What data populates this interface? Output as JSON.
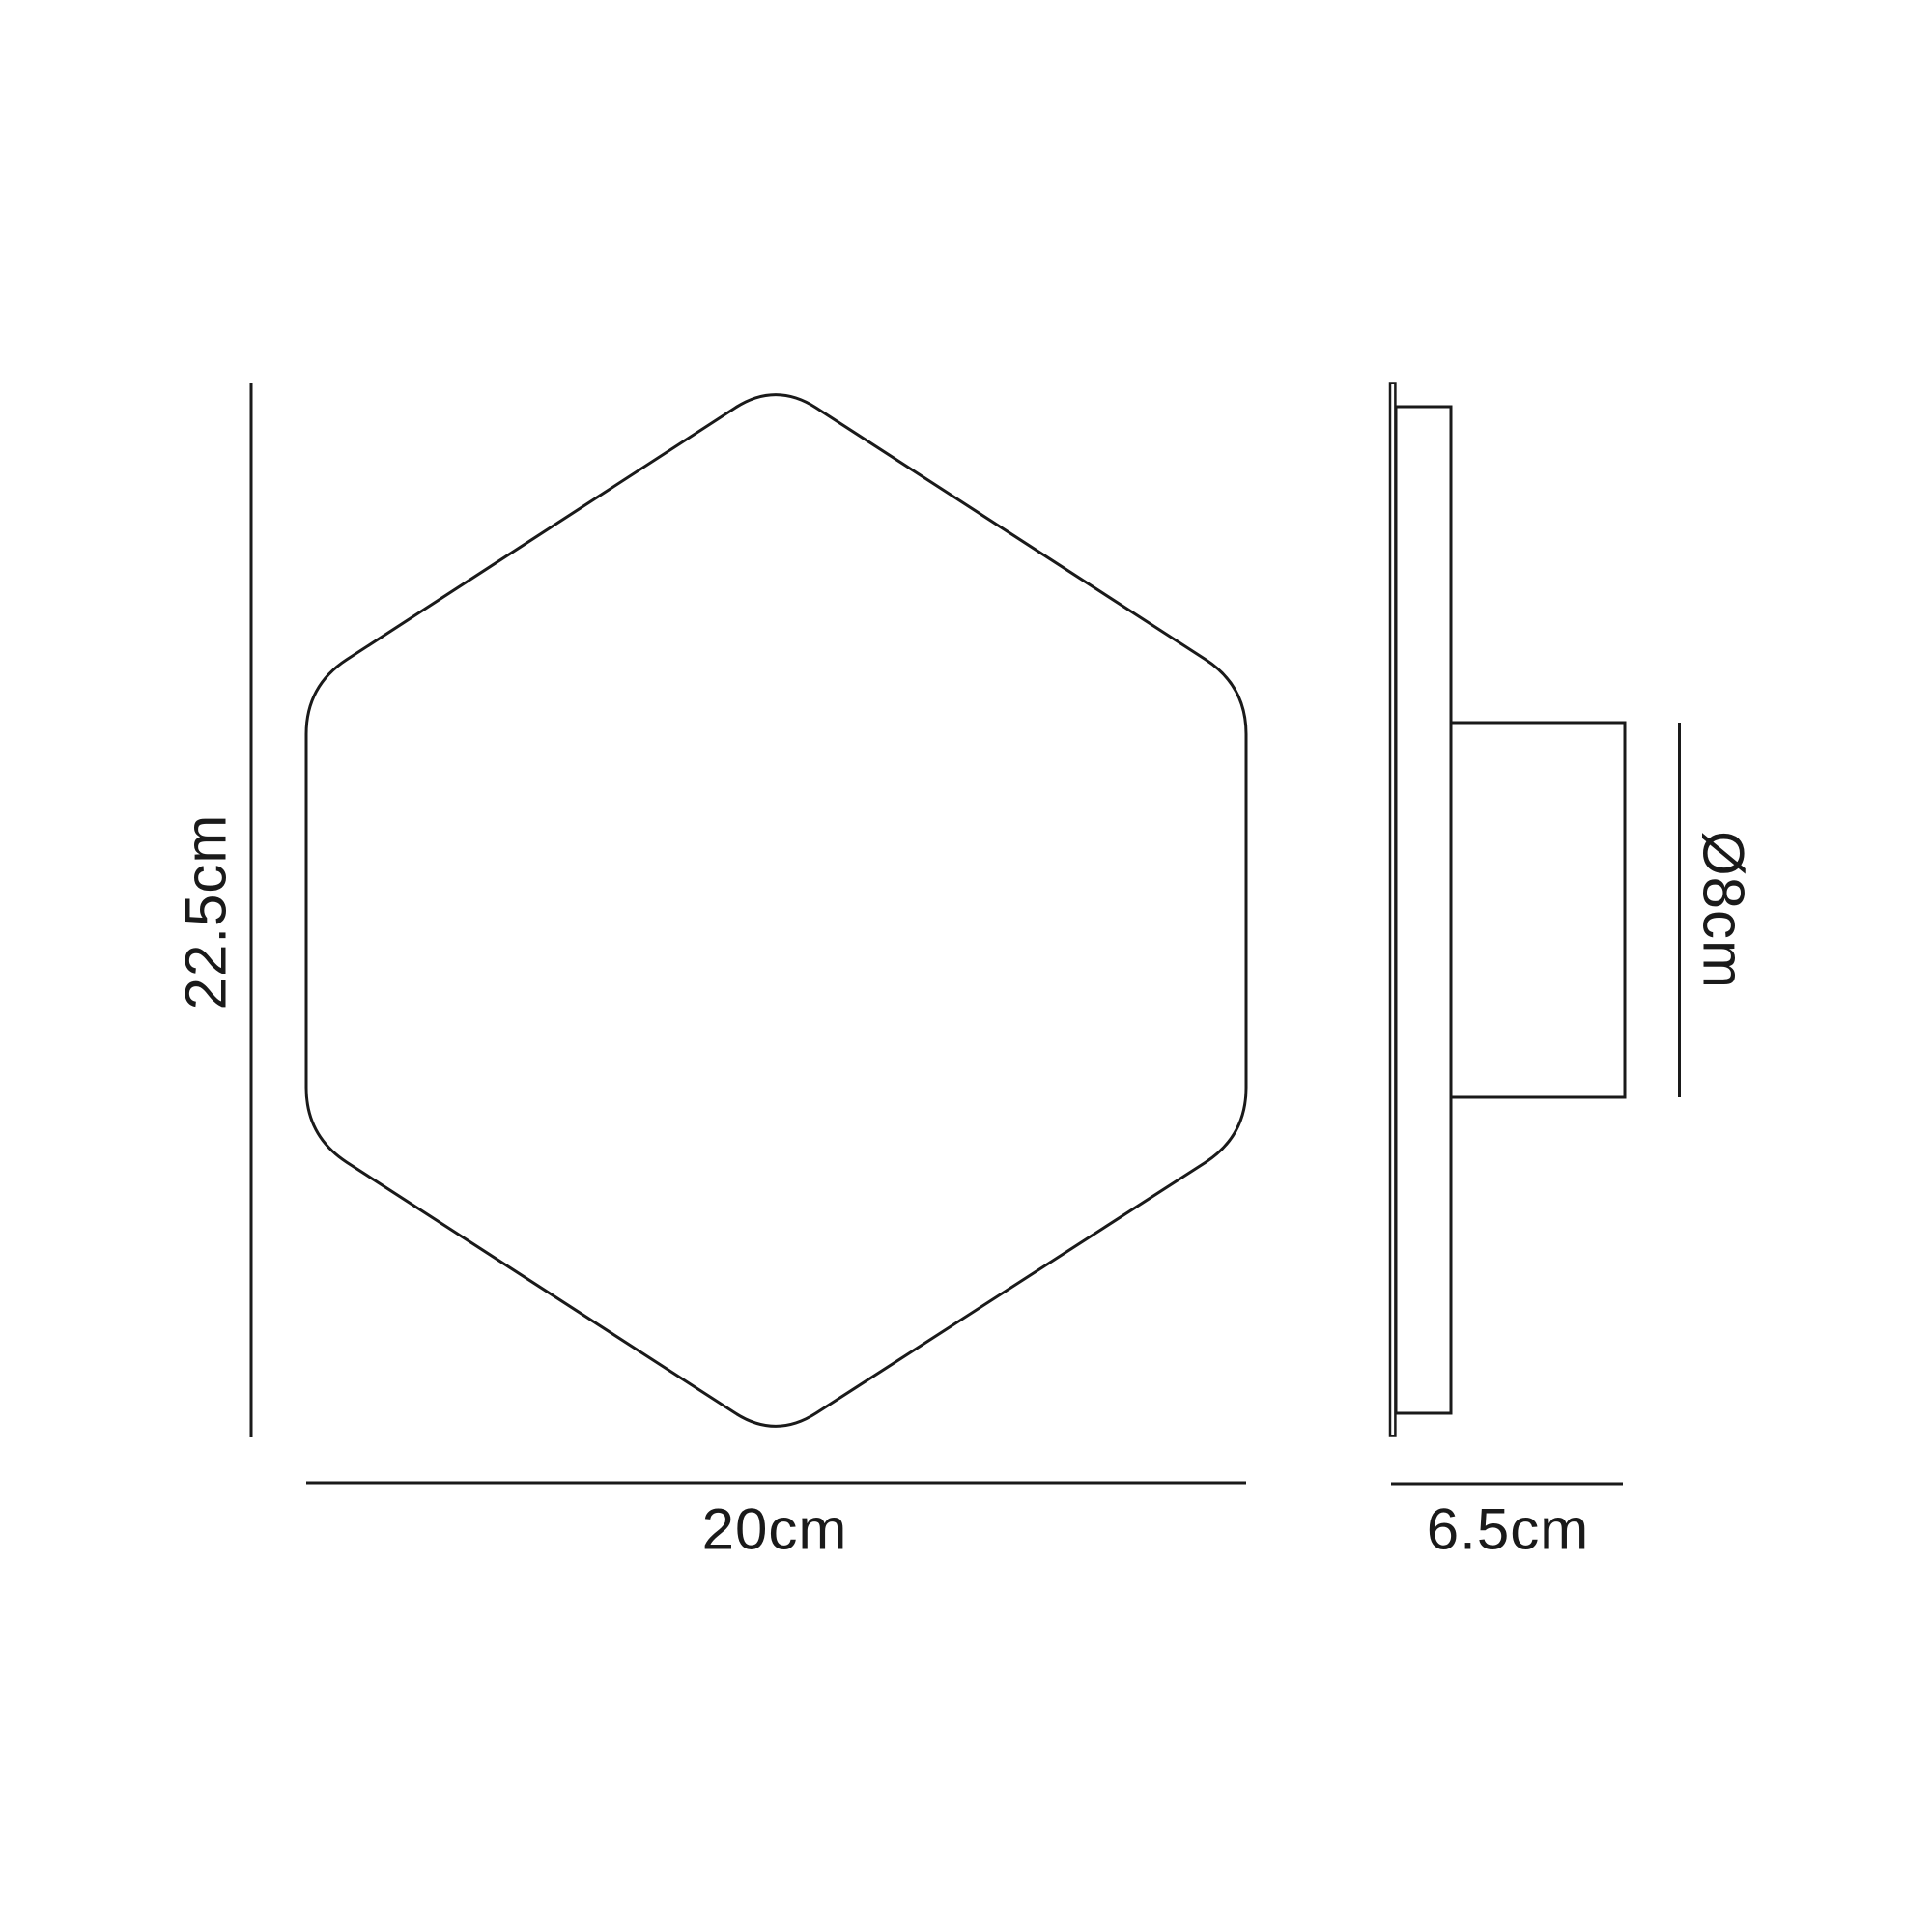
{
  "diagram": {
    "background_color": "#ffffff",
    "line_color": "#1a1a1a",
    "text_color": "#1a1a1a",
    "front_view": {
      "height_label": "22.5cm",
      "width_label": "20cm"
    },
    "side_view": {
      "diameter_label": "Ø8cm",
      "depth_label": "6.5cm"
    }
  }
}
